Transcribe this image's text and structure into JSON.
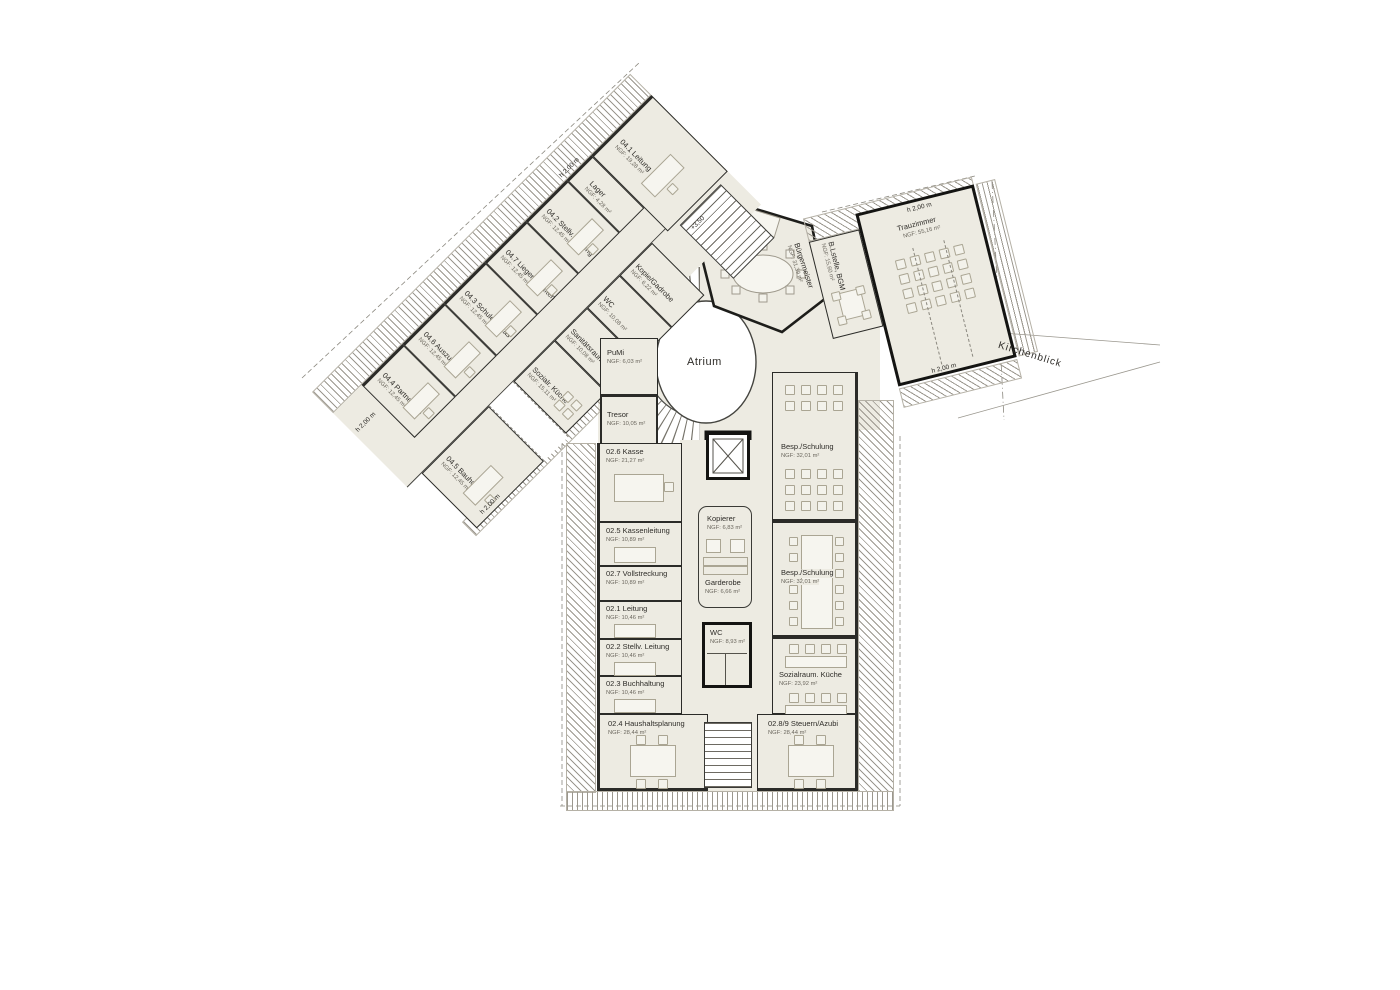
{
  "labels": {
    "atrium": "Atrium",
    "kirchenblick": "Kirchenblick",
    "level_marker": "+3,50",
    "h_clearance": "h 2,00 m"
  },
  "wing_upper": {
    "nw_rooms": [
      {
        "name": "04.4 Partnersch.",
        "area": "NGF: 12,45 m²"
      },
      {
        "name": "04.6 Auszubild.",
        "area": "NGF: 12,45 m²"
      },
      {
        "name": "04.3 Schulen Kitas",
        "area": "NGF: 12,45 m²"
      },
      {
        "name": "04.7 Liegenschaften",
        "area": "NGF: 12,45 m²"
      },
      {
        "name": "04.2 Stellv. Leitung",
        "area": "NGF: 12,45 m²"
      },
      {
        "name": "Lager",
        "area": "NGF: 4,28 m²"
      },
      {
        "name": "04.1 Leitung",
        "area": "NGF: 19,28 m²"
      }
    ],
    "se_rooms": [
      {
        "name": "04.5 Bauhof",
        "area": "NGF: 12,45 m²"
      },
      {
        "name": "Sozialr. Küche",
        "area": "NGF: 15,11 m²"
      },
      {
        "name": "Sanitätsraum",
        "area": "NGF: 10,08 m²"
      },
      {
        "name": "WC",
        "area": "NGF: 10,08 m²"
      },
      {
        "name": "Kopie/Gadrobe",
        "area": "NGF: 6,22 m²"
      }
    ]
  },
  "center": {
    "pumi": {
      "name": "PuMi",
      "area": "NGF: 6,03 m²"
    },
    "tresor": {
      "name": "Tresor",
      "area": "NGF: 10,05 m²"
    }
  },
  "east_wing": {
    "buergermeister": {
      "name": "Bürgermeister",
      "area": "NGF: 31,39 m²"
    },
    "blstelle": {
      "name": "B.Lstelle, BGM",
      "area": "NGF: 15,60 m²"
    },
    "trauzimmer": {
      "name": "Trauzimmer",
      "area": "NGF: 55,16 m²"
    }
  },
  "south_block": {
    "left": [
      {
        "name": "02.6 Kasse",
        "area": "NGF: 21,27 m²"
      },
      {
        "name": "02.5 Kassenleitung",
        "area": "NGF: 10,89 m²"
      },
      {
        "name": "02.7 Vollstreckung",
        "area": "NGF: 10,89 m²"
      },
      {
        "name": "02.1 Leitung",
        "area": "NGF: 10,46 m²"
      },
      {
        "name": "02.2 Stellv. Leitung",
        "area": "NGF: 10,46 m²"
      },
      {
        "name": "02.3 Buchhaltung",
        "area": "NGF: 10,46 m²"
      },
      {
        "name": "02.4 Haushaltsplanung",
        "area": "NGF: 28,44 m²"
      }
    ],
    "core": [
      {
        "name": "Kopierer",
        "area": "NGF: 6,83 m²"
      },
      {
        "name": "Garderobe",
        "area": "NGF: 6,66 m²"
      },
      {
        "name": "WC",
        "area": "NGF: 8,93 m²"
      }
    ],
    "right": [
      {
        "name": "Besp./Schulung",
        "area": "NGF: 32,01 m²"
      },
      {
        "name": "Besp./Schulung",
        "area": "NGF: 32,01 m²"
      },
      {
        "name": "Sozialraum. Küche",
        "area": "NGF: 23,92 m²"
      },
      {
        "name": "02.8/9 Steuern/Azubi",
        "area": "NGF: 28,44 m²"
      }
    ]
  }
}
